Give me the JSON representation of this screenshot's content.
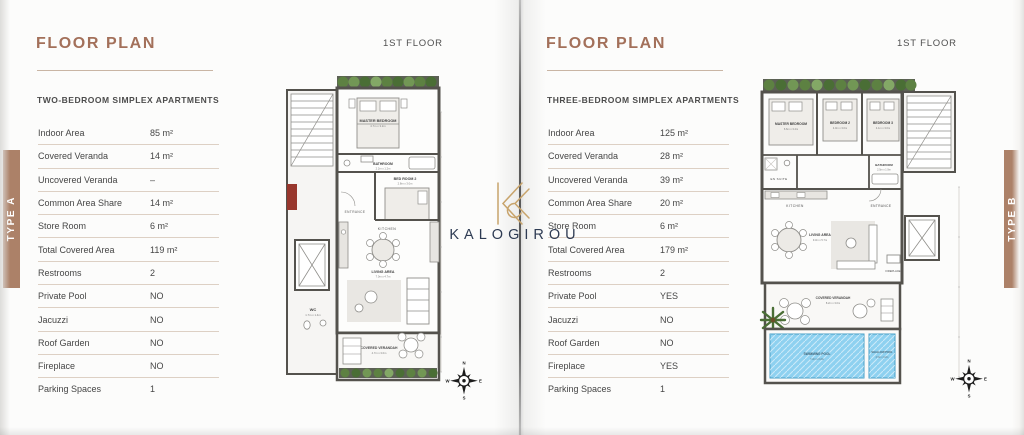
{
  "brand": {
    "name": "KALOGIROU",
    "monogram": "K",
    "gold": "#c8a46c",
    "navy": "#2e3b53"
  },
  "compass": {
    "n": "N",
    "e": "E",
    "s": "S",
    "w": "W"
  },
  "left_page": {
    "tab": "TYPE A",
    "title": "FLOOR PLAN",
    "floor": "1ST FLOOR",
    "subtitle": "TWO-BEDROOM SIMPLEX APARTMENTS",
    "specs": [
      {
        "label": "Indoor Area",
        "value": "85 m²"
      },
      {
        "label": "Covered Veranda",
        "value": "14 m²"
      },
      {
        "label": "Uncovered Veranda",
        "value": "–"
      },
      {
        "label": "Common Area Share",
        "value": "14 m²"
      },
      {
        "label": "Store Room",
        "value": "6 m²"
      },
      {
        "label": "Total Covered Area",
        "value": "119 m²"
      },
      {
        "label": "Restrooms",
        "value": "2"
      },
      {
        "label": "Private Pool",
        "value": "NO"
      },
      {
        "label": "Jacuzzi",
        "value": "NO"
      },
      {
        "label": "Roof Garden",
        "value": "NO"
      },
      {
        "label": "Fireplace",
        "value": "NO"
      },
      {
        "label": "Parking Spaces",
        "value": "1"
      }
    ],
    "plan": {
      "master": {
        "name": "MASTER BEDROOM",
        "dim": "4.7m x 3.2m"
      },
      "bathroom": {
        "name": "BATHROOM",
        "dim": "2.2m x 1.2m"
      },
      "bed2": {
        "name": "BED ROOM 2",
        "dim": "2.8m x 3.0m"
      },
      "entrance": {
        "name": "ENTRANCE"
      },
      "kitchen": {
        "name": "KITCHEN"
      },
      "wc": {
        "name": "WC",
        "dim": "1.7m x 1.4m"
      },
      "living": {
        "name": "LIVING AREA",
        "dim": "7.0m x 4.7m"
      },
      "veranda": {
        "name": "COVERED VERANDAH",
        "dim": "4.7m x 3.0m"
      }
    }
  },
  "right_page": {
    "tab": "TYPE B",
    "title": "FLOOR PLAN",
    "floor": "1ST FLOOR",
    "subtitle": "THREE-BEDROOM SIMPLEX APARTMENTS",
    "specs": [
      {
        "label": "Indoor Area",
        "value": "125 m²"
      },
      {
        "label": "Covered Veranda",
        "value": "28 m²"
      },
      {
        "label": "Uncovered Veranda",
        "value": "39 m²"
      },
      {
        "label": "Common Area Share",
        "value": "20 m²"
      },
      {
        "label": "Store Room",
        "value": "6 m²"
      },
      {
        "label": "Total Covered Area",
        "value": "179 m²"
      },
      {
        "label": "Restrooms",
        "value": "2"
      },
      {
        "label": "Private Pool",
        "value": "YES"
      },
      {
        "label": "Jacuzzi",
        "value": "NO"
      },
      {
        "label": "Roof Garden",
        "value": "NO"
      },
      {
        "label": "Fireplace",
        "value": "YES"
      },
      {
        "label": "Parking Spaces",
        "value": "1"
      }
    ],
    "plan": {
      "master": {
        "name": "MASTER BEDROOM",
        "dim": "6.6m x 3.4m"
      },
      "bed2": {
        "name": "BEDROOM 2",
        "dim": "4.0m x 3.0m"
      },
      "bed3": {
        "name": "BEDROOM 3",
        "dim": "4.1m x 3.0m"
      },
      "ensuite": {
        "name": "EN SUITE"
      },
      "bathroom": {
        "name": "BATHROOM",
        "dim": "2.5m x 1.9m"
      },
      "kitchen": {
        "name": "KITCHEN"
      },
      "entrance": {
        "name": "ENTRANCE"
      },
      "living": {
        "name": "LIVING AREA",
        "dim": "9.3m x 5.7m"
      },
      "fireplace": {
        "name": "FIREPLACE"
      },
      "veranda": {
        "name": "COVERED VERANDAH",
        "dim": "8.2m x 3.0m"
      },
      "pool": {
        "name": "SWIMMING POOL",
        "dim": "7.2m x 3.2m"
      },
      "shallow": {
        "name": "SHALLOW POOL",
        "dim": "2.5m x 3.2m"
      }
    }
  }
}
